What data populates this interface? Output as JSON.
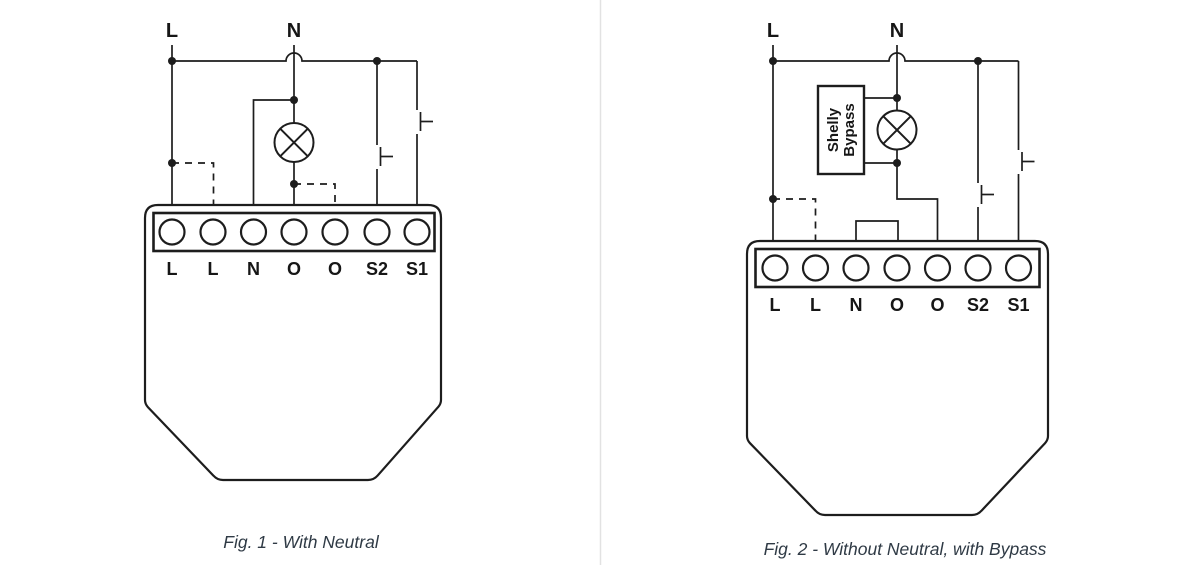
{
  "colors": {
    "line": "#1d1d1d",
    "caption_text": "#2f3a45",
    "divider": "#e2e2e2",
    "background": "#ffffff"
  },
  "fig1": {
    "caption": "Fig. 1 - With Neutral",
    "supply": {
      "l": "L",
      "n": "N"
    },
    "terminals": [
      "L",
      "L",
      "N",
      "O",
      "O",
      "S2",
      "S1"
    ]
  },
  "fig2": {
    "caption": "Fig. 2 - Without Neutral, with Bypass",
    "supply": {
      "l": "L",
      "n": "N"
    },
    "terminals": [
      "L",
      "L",
      "N",
      "O",
      "O",
      "S2",
      "S1"
    ],
    "bypass": {
      "line1": "Shelly",
      "line2": "Bypass"
    }
  }
}
